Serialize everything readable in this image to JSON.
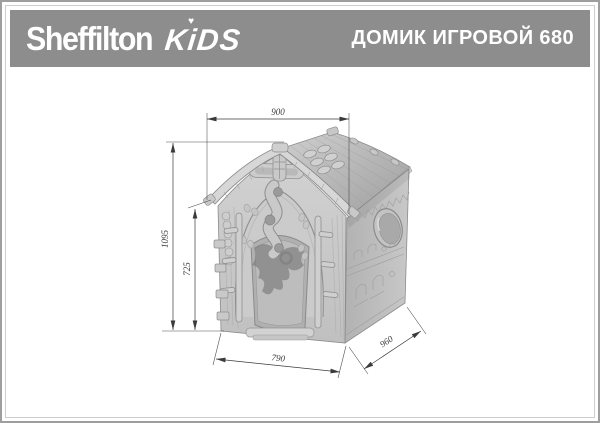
{
  "header": {
    "brand": "Sheffilton",
    "brand_kids": "KiDS",
    "heart_glyph": "♥",
    "title": "ДОМИК ИГРОВОЙ 680"
  },
  "drawing": {
    "dim_roof_width": "900",
    "dim_total_height": "1095",
    "dim_wall_height": "725",
    "dim_front_width": "790",
    "dim_side_depth": "960"
  },
  "colors": {
    "header_bg": "#8d8d8d",
    "header_text": "#ffffff",
    "dimension_lines": "#3a3a3a",
    "house_light": "#d6d6d6",
    "house_mid": "#c2c2c2",
    "house_dark": "#8c8c8c"
  }
}
